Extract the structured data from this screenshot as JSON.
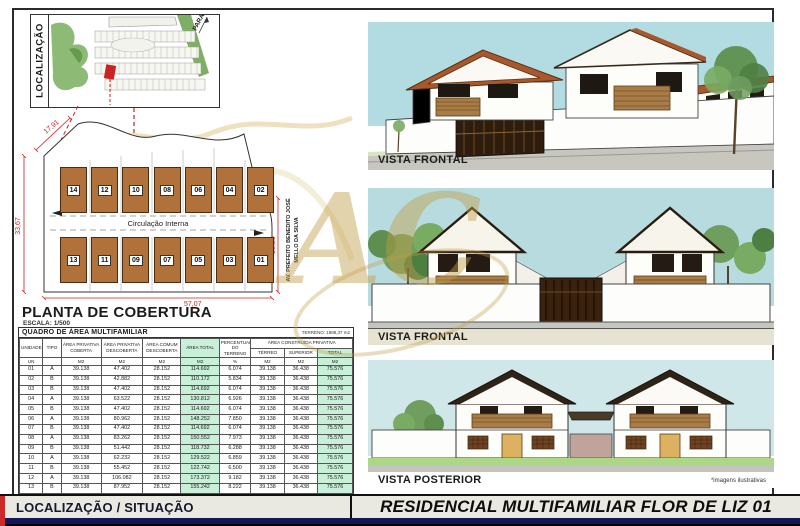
{
  "title_block": {
    "left": "LOCALIZAÇÃO / SITUAÇÃO",
    "right": "RESIDENCIAL MULTIFAMILIAR FLOR DE LIZ 01",
    "note": "*imagens ilustrativas"
  },
  "localizacao": {
    "label": "LOCALIZAÇÃO",
    "street_label": "PARATY"
  },
  "planta": {
    "title": "PLANTA DE COBERTURA",
    "scale": "ESCALA: 1/500",
    "circulation": "Circulação Interna",
    "street_line1": "AV. PREFEITO BENEDITO JOSÉ",
    "street_line2": "MELLO DA SILVA",
    "dim_top": "17,91",
    "dim_left": "33,67",
    "dim_bottom": "57,07",
    "dim_right": "28,20",
    "units_top": [
      "14",
      "12",
      "10",
      "08",
      "06",
      "04",
      "02"
    ],
    "units_bottom": [
      "13",
      "11",
      "09",
      "07",
      "05",
      "03",
      "01"
    ]
  },
  "vistas": [
    {
      "label": "VISTA FRONTAL"
    },
    {
      "label": "VISTA FRONTAL"
    },
    {
      "label": "VISTA POSTERIOR"
    }
  ],
  "quadro": {
    "title": "QUADRO DE ÁREA MULTIFAMILIAR",
    "terreno": "TERRENO: 1888,37 m2",
    "group_header": "ÁREA CONSTRUÍDA PRIVATIVA",
    "columns": [
      {
        "label": "UNIDADE",
        "unit": "UN"
      },
      {
        "label": "TIPO",
        "unit": ""
      },
      {
        "label": "ÁREA PRIVATIVA COBERTA",
        "unit": "M2"
      },
      {
        "label": "ÁREA PRIVATIVA DESCOBERTA",
        "unit": "M2"
      },
      {
        "label": "ÁREA COMUM DESCOBERTA",
        "unit": "M2"
      },
      {
        "label": "ÁREA TOTAL",
        "unit": "M2"
      },
      {
        "label": "PERCENTUAL DO TERRENO",
        "unit": "%"
      },
      {
        "label": "TÉRREO",
        "unit": "M2"
      },
      {
        "label": "SUPERIOR",
        "unit": "M2"
      },
      {
        "label": "TOTAL",
        "unit": "M2"
      }
    ],
    "rows": [
      [
        "01",
        "A",
        "39.138",
        "47.402",
        "28.152",
        "114.692",
        "6.074",
        "39.138",
        "36.438",
        "75.576"
      ],
      [
        "02",
        "B",
        "39.138",
        "42.882",
        "28.152",
        "110.172",
        "5.834",
        "39.138",
        "36.438",
        "75.576"
      ],
      [
        "03",
        "B",
        "39.138",
        "47.402",
        "28.152",
        "114.692",
        "6.074",
        "39.138",
        "36.438",
        "75.576"
      ],
      [
        "04",
        "A",
        "39.138",
        "63.522",
        "28.152",
        "130.812",
        "6.926",
        "39.138",
        "36.438",
        "75.576"
      ],
      [
        "05",
        "B",
        "39.138",
        "47.402",
        "28.152",
        "114.692",
        "6.074",
        "39.138",
        "36.438",
        "75.576"
      ],
      [
        "06",
        "A",
        "39.138",
        "80.962",
        "28.152",
        "148.252",
        "7.850",
        "39.138",
        "36.438",
        "75.576"
      ],
      [
        "07",
        "B",
        "39.138",
        "47.402",
        "28.152",
        "114.692",
        "6.074",
        "39.138",
        "36.438",
        "75.576"
      ],
      [
        "08",
        "A",
        "39.138",
        "83.262",
        "28.152",
        "150.552",
        "7.973",
        "39.138",
        "36.438",
        "75.576"
      ],
      [
        "09",
        "B",
        "39.138",
        "51.442",
        "28.152",
        "118.732",
        "6.288",
        "39.138",
        "36.438",
        "75.576"
      ],
      [
        "10",
        "A",
        "39.138",
        "62.232",
        "28.152",
        "129.522",
        "6.859",
        "39.138",
        "36.438",
        "75.576"
      ],
      [
        "11",
        "B",
        "39.138",
        "55.452",
        "28.152",
        "122.742",
        "6.500",
        "39.138",
        "36.438",
        "75.576"
      ],
      [
        "12",
        "A",
        "39.138",
        "106.082",
        "28.152",
        "173.372",
        "9.182",
        "39.138",
        "36.438",
        "75.576"
      ],
      [
        "13",
        "B",
        "39.138",
        "87.952",
        "28.152",
        "155.242",
        "8.222",
        "39.138",
        "36.438",
        "75.576"
      ],
      [
        "14",
        "A",
        "39.138",
        "122.912",
        "28.152",
        "190.202",
        "10.071",
        "39.138",
        "36.438",
        "75.576"
      ]
    ],
    "total_row": [
      "TOTAL",
      "",
      "547.932",
      "946.308",
      "394.13",
      "1888.37",
      "100.00",
      "547.932",
      "510.132",
      "1058.064"
    ]
  },
  "colors": {
    "dimension_red": "#cc2222",
    "table_green": "#c8efd8",
    "roof_brown": "#b0713b",
    "wood": "#a87c46",
    "navy_bar": "#15155a",
    "watermark_gold": "#c19d48",
    "sky": "#b2dce2"
  }
}
